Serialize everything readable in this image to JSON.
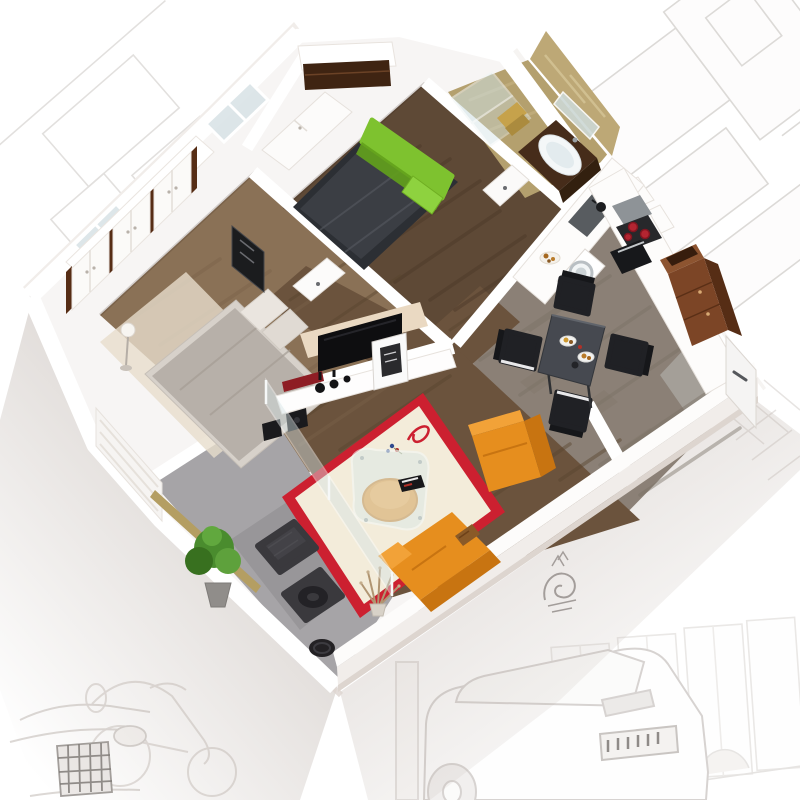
{
  "scene": {
    "type": "3d-floor-plan-cutaway-render",
    "description": "Isometric top-down cutaway render of a one-bedroom apartment on a white background surrounded by faint pencil concept sketches of buildings, windows, cars and a scooter",
    "rooms": [
      {
        "name": "main-bedroom",
        "floor": "dark walnut plank floor",
        "furniture": [
          "double bed with charcoal duvet",
          "lime green headboard",
          "lime green cushion",
          "built-in closet with white sliding door and dark wood interior",
          "window"
        ]
      },
      {
        "name": "bathroom",
        "floor": "beige marble floor and walls",
        "furniture": [
          "glass shower screen",
          "white oval basin on dark wood vanity",
          "wall mirror",
          "gold towels",
          "white door"
        ]
      },
      {
        "name": "kitchen-dining",
        "floor": "grey oak plank floor",
        "furniture": [
          "L-shaped white counter",
          "inset sink",
          "washing machine",
          "hob with red pots",
          "black oven",
          "tall mahogany cabinet cut open at top",
          "grey dining table",
          "four black chairs with white seat trim",
          "plates with food",
          "pastry plate"
        ]
      },
      {
        "name": "entrance-hall",
        "floor": "grey floor",
        "furniture": [
          "white entrance door with handle",
          "white hall cabinets"
        ]
      },
      {
        "name": "living-room",
        "floor": "walnut plank floor",
        "furniture": [
          "cream rug with red border and red swirl motif",
          "glass coffee table",
          "orange pouf",
          "magazines",
          "orange sofa with patterned pillow",
          "orange armchair",
          "white TV shelf unit",
          "black TV panel on cream accent wall",
          "dark red media shelf",
          "black vases",
          "leaning framed artwork",
          "black speakers",
          "dried branch decor"
        ]
      },
      {
        "name": "second-bedroom",
        "floor": "oak plank floor",
        "furniture": [
          "double bed with grey duvet and two pillows",
          "three white wardrobes with dark wood trim",
          "beige rug",
          "floor lamp",
          "dark framed artwork",
          "window"
        ]
      },
      {
        "name": "balcony",
        "floor": "grey tile floor",
        "furniture": [
          "potted green plant",
          "two dark wicker chairs",
          "black side table",
          "glass partition",
          "white lattice privacy screen",
          "gold threshold strip"
        ]
      }
    ],
    "background_sketches": [
      "building facade frames top-right",
      "faint frames top-left",
      "window row with bushes bottom-right",
      "rear of estate car",
      "scooter",
      "car front with dark grille",
      "dark shrub doodle",
      "diamond trellis"
    ]
  },
  "palette": {
    "bg": "#ffffff",
    "sketch": "#d9d6d3",
    "sketchDark": "#8b8785",
    "slab": "#f7f5f4",
    "wallTop": "#ffffff",
    "wallFace": "#f1edea",
    "wallShade": "#ddd5cf",
    "wood1": "#8a7156",
    "wood1s": "#79614a",
    "wood2": "#5e4936",
    "wood2s": "#4b3828",
    "wood3": "#6b533d",
    "wood3s": "#59442f",
    "wood4": "#8b8076",
    "wood4s": "#797066",
    "balc": "#a6a4a7",
    "balcD": "#8f8d90",
    "tanF": "#b4a06e",
    "tanW": "#bda876",
    "glass": "#cfe0e2",
    "glassBlue": "#d8e2e6",
    "green": "#7ec22f",
    "greenD": "#63a11c",
    "plant": "#4a8c2e",
    "plantD": "#38701f",
    "char": "#3b3e44",
    "charL": "#565a61",
    "org": "#e68e1e",
    "orgD": "#c87411",
    "orgL": "#f2a238",
    "red": "#cc2030",
    "rugC": "#f3ecda",
    "rugB": "#e7ddcc",
    "mah": "#7c4526",
    "mahD": "#562d15",
    "bedG": "#b7b0a9",
    "gold": "#b49e62",
    "steel": "#9aa0a4",
    "hallG": "#a8a49f"
  }
}
